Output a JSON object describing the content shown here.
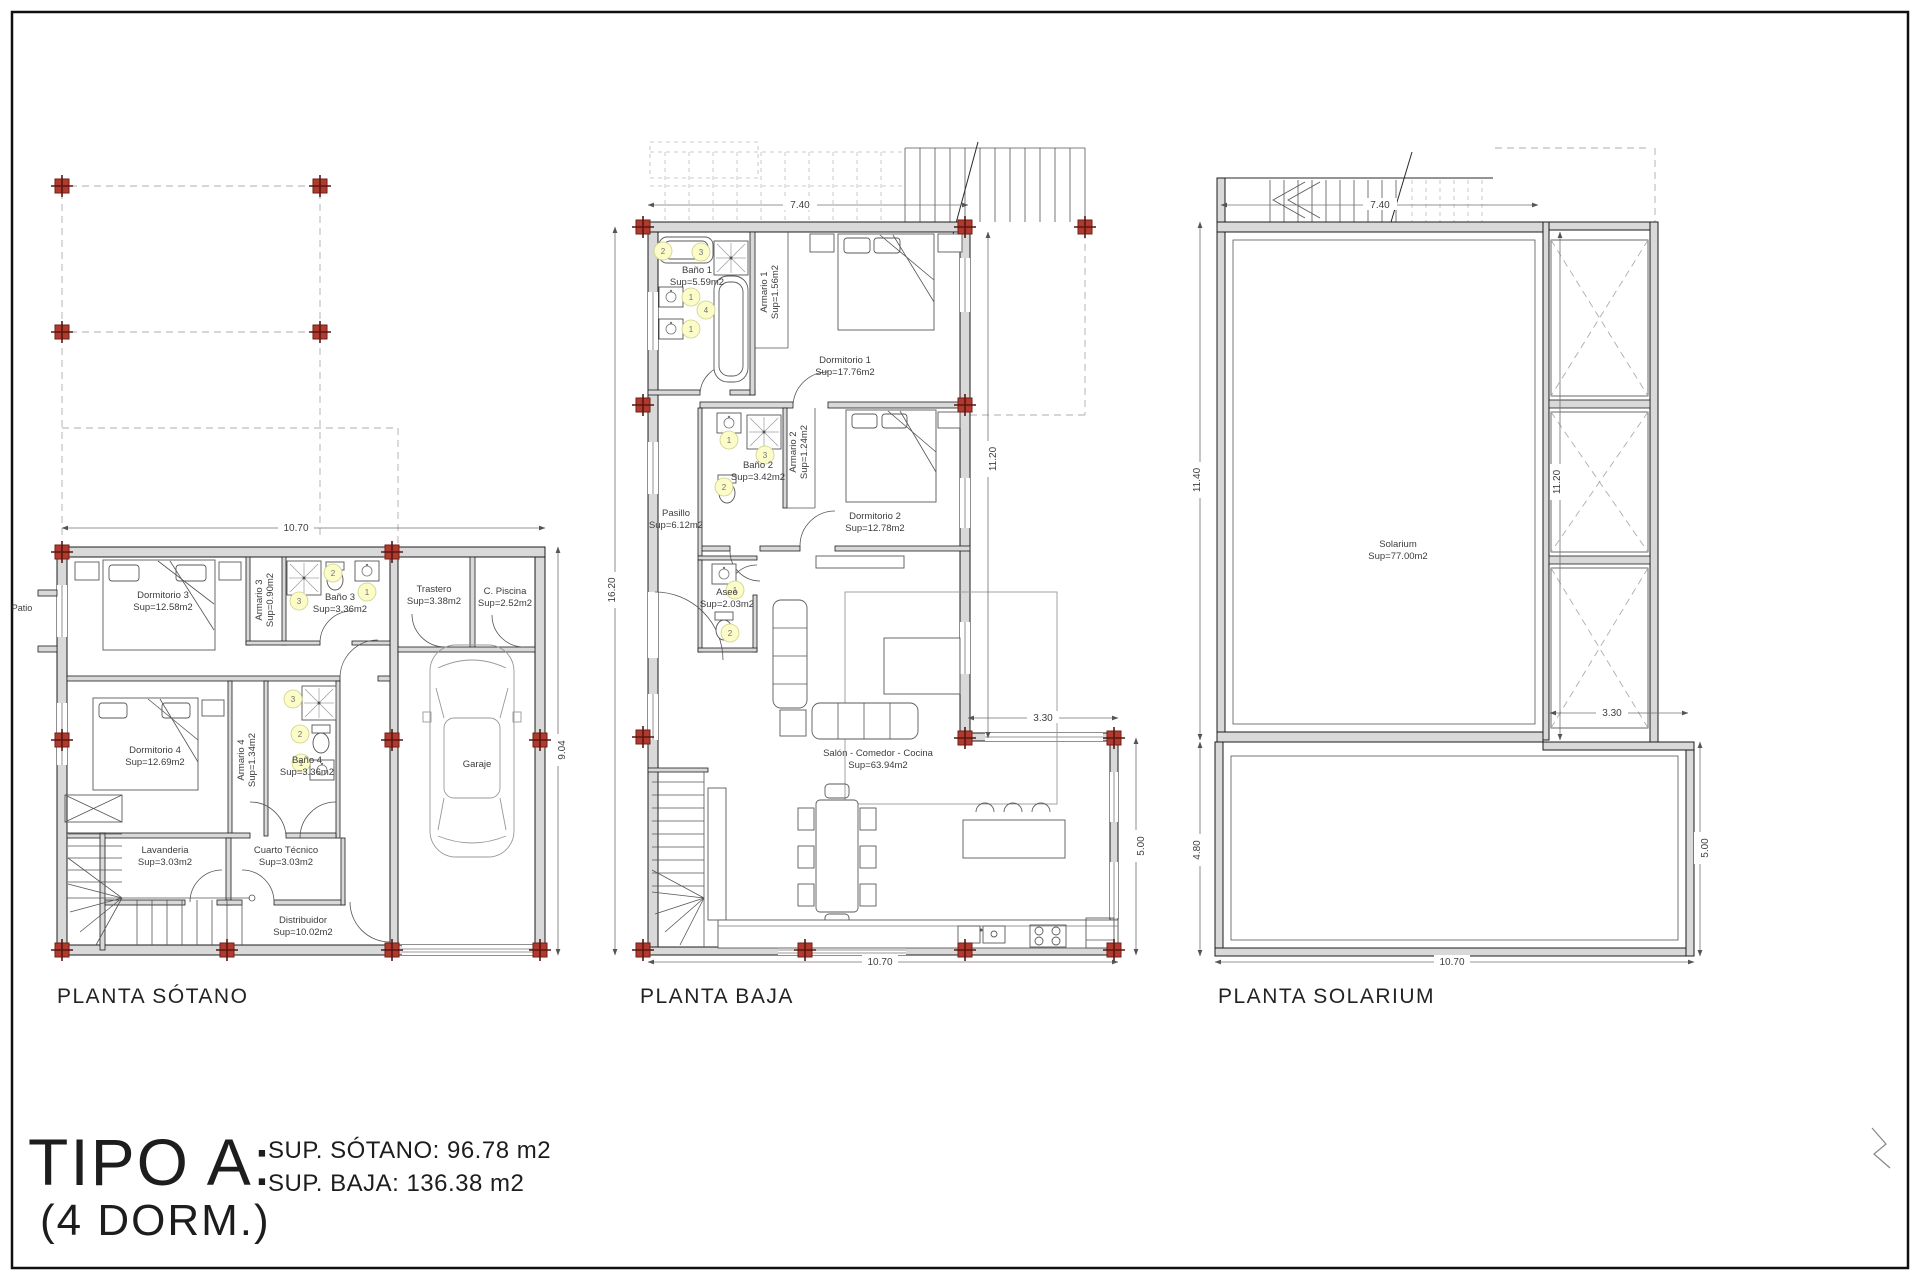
{
  "sheet": {
    "type_title": "TIPO A:",
    "type_subtitle": "(4 DORM.)",
    "summary_line1": "SUP. SÓTANO: 96.78 m2",
    "summary_line2": "SUP. BAJA: 136.38 m2",
    "frame_color": "#111111",
    "column_marker_color": "#b03a2e",
    "badge_fill": "#fcfcc8"
  },
  "badges": {
    "n1": "1",
    "n2": "2",
    "n3": "3",
    "n4": "4"
  },
  "plans": {
    "sotano": {
      "title": "PLANTA SÓTANO",
      "patio": "Patio",
      "dims": {
        "width": "10.70",
        "height": "9.04"
      },
      "rooms": [
        {
          "name": "Dormitorio 3",
          "sup": "Sup=12.58m2"
        },
        {
          "name": "Armario 3",
          "sup": "Sup=0.90m2"
        },
        {
          "name": "Baño 3",
          "sup": "Sup=3.36m2"
        },
        {
          "name": "Trastero",
          "sup": "Sup=3.38m2"
        },
        {
          "name": "C. Piscina",
          "sup": "Sup=2.52m2"
        },
        {
          "name": "Dormitorio 4",
          "sup": "Sup=12.69m2"
        },
        {
          "name": "Armario 4",
          "sup": "Sup=1.34m2"
        },
        {
          "name": "Baño 4",
          "sup": "Sup=3.36m2"
        },
        {
          "name": "Lavanderia",
          "sup": "Sup=3.03m2"
        },
        {
          "name": "Cuarto Técnico",
          "sup": "Sup=3.03m2"
        },
        {
          "name": "Distribuidor",
          "sup": "Sup=10.02m2"
        },
        {
          "name": "Garaje",
          "sup": "Sup=19.66m2"
        }
      ]
    },
    "baja": {
      "title": "PLANTA BAJA",
      "dims": {
        "top": "7.40",
        "left": "16.20",
        "right": "11.20",
        "ext_width": "3.30",
        "ext_height": "5.00",
        "bottom": "10.70"
      },
      "rooms": [
        {
          "name": "Baño 1",
          "sup": "Sup=5.59m2"
        },
        {
          "name": "Armario 1",
          "sup": "Sup=1.56m2"
        },
        {
          "name": "Dormitorio 1",
          "sup": "Sup=17.76m2"
        },
        {
          "name": "Baño 2",
          "sup": "Sup=3.42m2"
        },
        {
          "name": "Armario 2",
          "sup": "Sup=1.24m2"
        },
        {
          "name": "Dormitorio 2",
          "sup": "Sup=12.78m2"
        },
        {
          "name": "Pasillo",
          "sup": "Sup=6.12m2"
        },
        {
          "name": "Aseo",
          "sup": "Sup=2.03m2"
        },
        {
          "name": "Salón - Comedor - Cocina",
          "sup": "Sup=63.94m2"
        }
      ]
    },
    "solarium": {
      "title": "PLANTA SOLARIUM",
      "dims": {
        "top": "7.40",
        "left": "11.40",
        "inner": "11.20",
        "ext_width": "3.30",
        "left_lower": "4.80",
        "right_lower": "5.00",
        "bottom": "10.70"
      },
      "rooms": [
        {
          "name": "Solarium",
          "sup": "Sup=77.00m2"
        }
      ]
    }
  }
}
